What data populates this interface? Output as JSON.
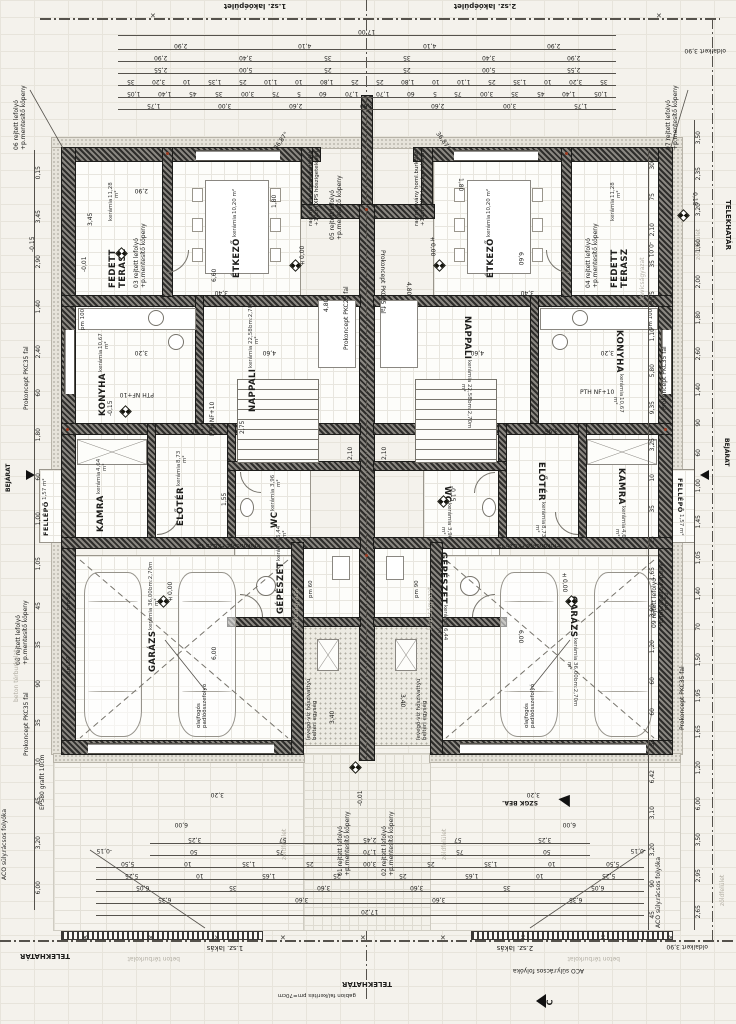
{
  "meta": {
    "building_left": "1.sz. lakóépület",
    "building_right": "2.sz. lakóépület",
    "unit_left": "1.sz. lakás",
    "unit_right": "2.sz. lakás",
    "total_top": "17,00",
    "total_bottom": "17,20",
    "side_yard": "oldalkert 3,90",
    "angle": "36,87°",
    "section_mark": "C"
  },
  "rooms": {
    "terasz": {
      "name": "FEDETT TERASZ",
      "material": "kerámia",
      "area": "11,28 m²"
    },
    "etkezo": {
      "name": "ÉTKEZŐ",
      "material": "kerámia",
      "area": "10,20 m²"
    },
    "nappali": {
      "name": "NAPPALI",
      "material": "kerámia",
      "area": "22,58 m²",
      "extra": "bm:2,70m"
    },
    "konyha": {
      "name": "KONYHA",
      "material": "kerámia",
      "area": "10,67 m²"
    },
    "kamra": {
      "name": "KAMRA",
      "material": "kerámia",
      "area": "4,64 m²"
    },
    "wc": {
      "name": "WC",
      "material": "kerámia",
      "area": "3,96 m²"
    },
    "eloter": {
      "name": "ELŐTÉR",
      "material": "kerámia",
      "area": "8,73 m²"
    },
    "gepeszet": {
      "name": "GÉPÉSZET",
      "material": "kerámia",
      "area": "6,44 m²"
    },
    "garazs": {
      "name": "GARÁZS",
      "material": "kerámia",
      "area": "36,00 m²",
      "extra": "bm:2,70m"
    },
    "fellepo": {
      "name": "FELLÉPŐ",
      "area": "1,57 m²"
    }
  },
  "callouts": {
    "c01": "01 rejtett lefolyó\n+p.mentesítő köpeny",
    "c02": "02 rejtett lefolyó\n+p.mentesítő köpeny",
    "c03": "03 rejtett lefolyó\n+p.mentesítő köpeny",
    "c04": "04 rejtett lefolyó\n+p.mentesítő köpeny",
    "c05": "05 rejtett lefolyó\n+p.mentesítő köpeny",
    "c06": "06 rejtett lefolyó\n+p.mentesítő köpeny",
    "c07": "07 rejtett lefolyó\n+p.mentesítő köpeny",
    "c08": "08 rejtett lefolyó\n+p.mentesítő köpeny",
    "c09": "09 rejtett lefolyó\n+p.mentesítő köpeny"
  },
  "notes": {
    "marble": "rag.márvány homl.burkolat\n+10cm XPS hőszigetelésen",
    "heatpump": "levegő-víz hőszivattyú\nbeltéri egység",
    "oil": "olajfogós\npadlóösszefolyó",
    "pkc35": "Prokoncept PKC35 fal",
    "pkc25": "Prokoncept PKC25 fal",
    "pth": "PTH NF+10",
    "eps": "EPS80 grafit 10cm",
    "aco": "ACO süly.rácsos folyóka",
    "telek": "TELEKHATÁR",
    "zold": "zöldfelület",
    "beton": "beton térburkolat",
    "kavics": "kavicságyazat",
    "gabion": "gabion fal/kerítés pm=70cm",
    "bejarat": "BEJÁRAT",
    "szgk": "SZGK BEÁ.",
    "pm100": "pm 100",
    "pm90": "pm 90",
    "pm50": "pm 50",
    "pm60": "pm 60"
  },
  "levels": {
    "zero": "±0,00",
    "m001": "-0,01",
    "m015": "-0,15"
  },
  "inner": {
    "d660": "6,60",
    "d480": "4,80",
    "d460": "4,60",
    "d600": "6,00",
    "d340": "3,40",
    "d320": "3,20",
    "d290": "2,90",
    "d280": "2,80",
    "d210": "2,10",
    "d180": "1,80",
    "d275": "2,75",
    "d155": "1,55",
    "d395": "3,95",
    "d345": "3,45",
    "d140": "1,40",
    "d240": "2,40",
    "d100": "1,00",
    "d390": "3,90"
  },
  "chains": {
    "top": [
      [
        "17,00"
      ],
      [
        "2,90",
        "4,10",
        "4,10",
        "2,90"
      ],
      [
        "2,90",
        "3,40",
        "35",
        "35",
        "3,40",
        "2,90"
      ],
      [
        "2,55",
        "5,00",
        "25",
        "25",
        "5,00",
        "2,55"
      ],
      [
        "35",
        "3,20",
        "10",
        "1,35",
        "25",
        "1,10",
        "10",
        "1,80",
        "25",
        "25",
        "1,80",
        "10",
        "1,10",
        "25",
        "1,35",
        "10",
        "3,20",
        "35"
      ],
      [
        "1,05",
        "1,40",
        "45",
        "35",
        "3,00",
        "75",
        "5",
        "60",
        "1,70",
        "1,70",
        "60",
        "5",
        "75",
        "3,00",
        "35",
        "45",
        "1,40",
        "1,05"
      ],
      [
        "1,75",
        "3,00",
        "2,60",
        "2,80",
        "2,60",
        "3,00",
        "1,75"
      ]
    ],
    "bottom": [
      [
        "3,25",
        "57",
        "2,45",
        "57",
        "3,25"
      ],
      [
        "50",
        "75",
        "1,70",
        "75",
        "50"
      ],
      [
        "5,50",
        "10",
        "1,35",
        "25",
        "3,00",
        "25",
        "1,35",
        "10",
        "5,50"
      ],
      [
        "5,25",
        "10",
        "1,65",
        "25",
        "25",
        "1,65",
        "10",
        "5,25"
      ],
      [
        "6,05",
        "35",
        "3,60",
        "3,60",
        "35",
        "6,05"
      ],
      [
        "6,35",
        "3,60",
        "3,60",
        "6,35"
      ],
      [
        "17,20"
      ]
    ],
    "left": [
      "0,15",
      "3,45",
      "2,90",
      "1,40",
      "2,40",
      "60",
      "1,80",
      "60",
      "1,00",
      "1,05",
      "45",
      "35",
      "90",
      "35",
      "10",
      "45",
      "3,20",
      "6,00"
    ],
    "right_a": [
      "3,50",
      "2,35",
      "3,20",
      "1,60",
      "2,00",
      "1,80",
      "2,60",
      "1,40",
      "90",
      "60",
      "1,00",
      "1,45",
      "1,05",
      "1,40",
      "70",
      "1,50",
      "1,95",
      "1,65",
      "1,20",
      "6,00",
      "3,50",
      "2,95",
      "2,65"
    ],
    "right_b": [
      "30",
      "75",
      "2,10",
      "35",
      "3,95",
      "1,10",
      "5,80",
      "9,35",
      "3,25",
      "10",
      "35",
      "25",
      "1,65",
      "3,90",
      "1,20",
      "60",
      "60",
      "35",
      "6,42",
      "3,10",
      "3,20",
      "90",
      "45"
    ]
  }
}
